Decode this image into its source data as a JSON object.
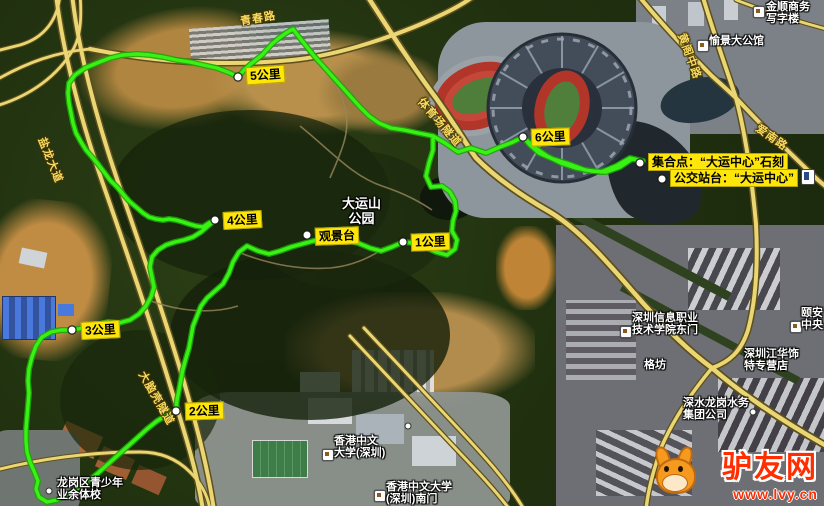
{
  "map_labels": {
    "km_markers": [
      {
        "label": "1公里"
      },
      {
        "label": "2公里"
      },
      {
        "label": "3公里"
      },
      {
        "label": "4公里"
      },
      {
        "label": "5公里"
      },
      {
        "label": "6公里"
      }
    ],
    "spot_labels": [
      {
        "label": "观景台"
      },
      {
        "label": "集合点：“大运中心”石刻"
      },
      {
        "label": "公交站台：“大运中心”"
      }
    ],
    "poi_labels": [
      {
        "id": "dayunshan-park",
        "lines": [
          "大运山",
          "公园"
        ]
      },
      {
        "id": "jinshun-office",
        "lines": [
          "金顺商务",
          "写字楼"
        ]
      },
      {
        "id": "yujing-mansion",
        "lines": [
          "愉景大公馆"
        ]
      },
      {
        "id": "yian-central",
        "lines": [
          "颐安",
          "中央"
        ]
      },
      {
        "id": "sziit-east-gate",
        "lines": [
          "深圳信息职业",
          "技术学院东门"
        ]
      },
      {
        "id": "gefang",
        "lines": [
          "格坊"
        ]
      },
      {
        "id": "jianghua-store",
        "lines": [
          "深圳江华饰",
          "特专营店"
        ]
      },
      {
        "id": "shenshui-water",
        "lines": [
          "深水龙岗水务",
          "集团公司"
        ]
      },
      {
        "id": "cuhk-shenzhen",
        "lines": [
          "香港中文",
          "大学(深圳)"
        ]
      },
      {
        "id": "cuhk-south-gate",
        "lines": [
          "香港中文大学",
          "(深圳)南门"
        ]
      },
      {
        "id": "sports-school",
        "lines": [
          "龙岗区青少年",
          "业余体校"
        ]
      }
    ],
    "road_labels": [
      {
        "text": "青春路"
      },
      {
        "text": "盐龙大道"
      },
      {
        "text": "大脑壳隧道"
      },
      {
        "text": "体育场隧道"
      },
      {
        "text": "黄阁中路"
      },
      {
        "text": "爱南路"
      }
    ],
    "watermark": {
      "site_name": "驴友网",
      "site_url": "www.lvy.cn"
    },
    "colors": {
      "route_green": "#2be60f",
      "label_yellow": "#ffe60a",
      "road_yellow": "#ead672"
    }
  }
}
